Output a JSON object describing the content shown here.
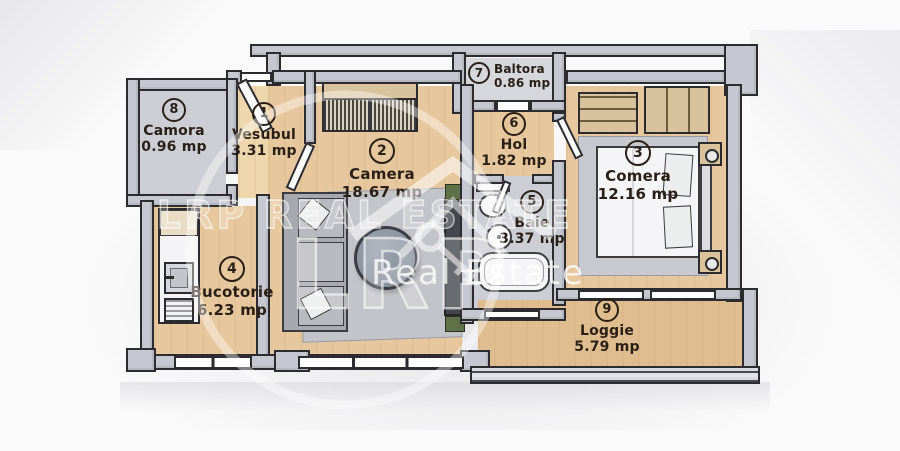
{
  "plan": {
    "type": "apartment-floor-plan",
    "area_unit": "mp"
  },
  "rooms": [
    {
      "number": "1",
      "name": "Vesubul",
      "area": "3.31 mp"
    },
    {
      "number": "2",
      "name": "Camera",
      "area": "18.67 mp"
    },
    {
      "number": "3",
      "name": "Comera",
      "area": "12.16 mp"
    },
    {
      "number": "4",
      "name": "Bucotorie",
      "area": "6.23 mp"
    },
    {
      "number": "5",
      "name": "Baie",
      "area": "3.37 mp"
    },
    {
      "number": "6",
      "name": "Hol",
      "area": "1.82 mp"
    },
    {
      "number": "7",
      "name": "Baltora",
      "area": "0.86 mp"
    },
    {
      "number": "8",
      "name": "Camora",
      "area": "0.96 mp"
    },
    {
      "number": "9",
      "name": "Loggie",
      "area": "5.79 mp"
    }
  ],
  "watermark": {
    "line1": "LRP REAL ESTATE",
    "brand": "LRP",
    "line2": "Real Estate"
  },
  "colors": {
    "walls": "#c6c8d1",
    "outline": "#2c2c30",
    "wood": "#e7c79d",
    "tile": "#cdced5",
    "label": "#2b2017",
    "watermark": "#ffffff"
  }
}
